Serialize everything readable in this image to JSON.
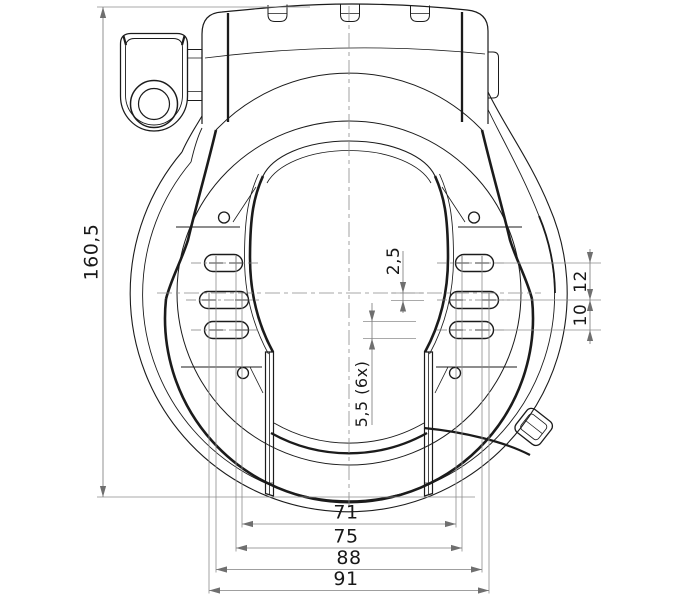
{
  "drawing": {
    "subject": "frame-lock-technical-drawing",
    "dimensions": {
      "overall_height": "160,5",
      "offset_center": "2,5",
      "slot_width": "5,5 (6x)",
      "pitch_upper": "12",
      "pitch_lower": "10",
      "span_71": "71",
      "span_75": "75",
      "span_88": "88",
      "span_91": "91"
    },
    "colors": {
      "background": "#ffffff",
      "object_line": "#1b1b1b",
      "dimension_line": "#7f7f7f",
      "label_text": "#181818"
    }
  }
}
